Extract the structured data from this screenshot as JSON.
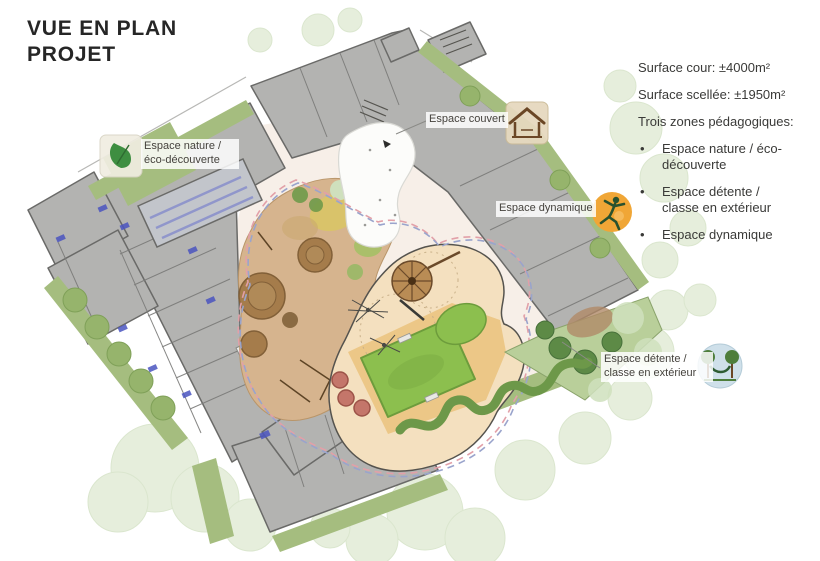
{
  "title": {
    "line1": "VUE EN PLAN",
    "line2": "PROJET"
  },
  "stats": {
    "surface_cour": "Surface cour: ±4000m²",
    "surface_scellee": "Surface scellée: ±1950m²",
    "zones_heading": "Trois zones pédagogiques:"
  },
  "legend": {
    "bullet": "•",
    "items": [
      {
        "label": "Espace nature / éco-découverte"
      },
      {
        "label": "Espace détente / classe en extérieur"
      },
      {
        "label": "Espace dynamique"
      }
    ]
  },
  "plan_labels": {
    "nature": "Espace nature / éco-découverte",
    "couvert": "Espace couvert",
    "dynamique": "Espace dynamique",
    "detente": "Espace détente / classe en extérieur"
  },
  "icons": [
    {
      "name": "leaf-icon",
      "zone": "Espace nature / éco-découverte"
    },
    {
      "name": "shelter-icon",
      "zone": "Espace couvert"
    },
    {
      "name": "jumping-figure-icon",
      "zone": "Espace dynamique"
    },
    {
      "name": "hammock-trees-icon",
      "zone": "Espace détente / classe en extérieur"
    }
  ],
  "colors": {
    "bg": "#ffffff",
    "text_dark": "#262626",
    "building_gray": "#b3b3b1",
    "building_wall": "#6a6a68",
    "green_strip": "#a5bd7f",
    "watercolor_tree": "#d7e4c6",
    "courtyard": "#f7efe8",
    "sand": "#f4e0bf",
    "tan_play": "#d6b48e",
    "field_green": "#8cbf4e",
    "hedge_green": "#6d9849",
    "path_pink": "#e2a0a8",
    "path_blue": "#9aa4cc",
    "icon_orange": "#f0a636",
    "pool_blue": "#8b92cc",
    "detente_green": "#b9cf9a"
  }
}
